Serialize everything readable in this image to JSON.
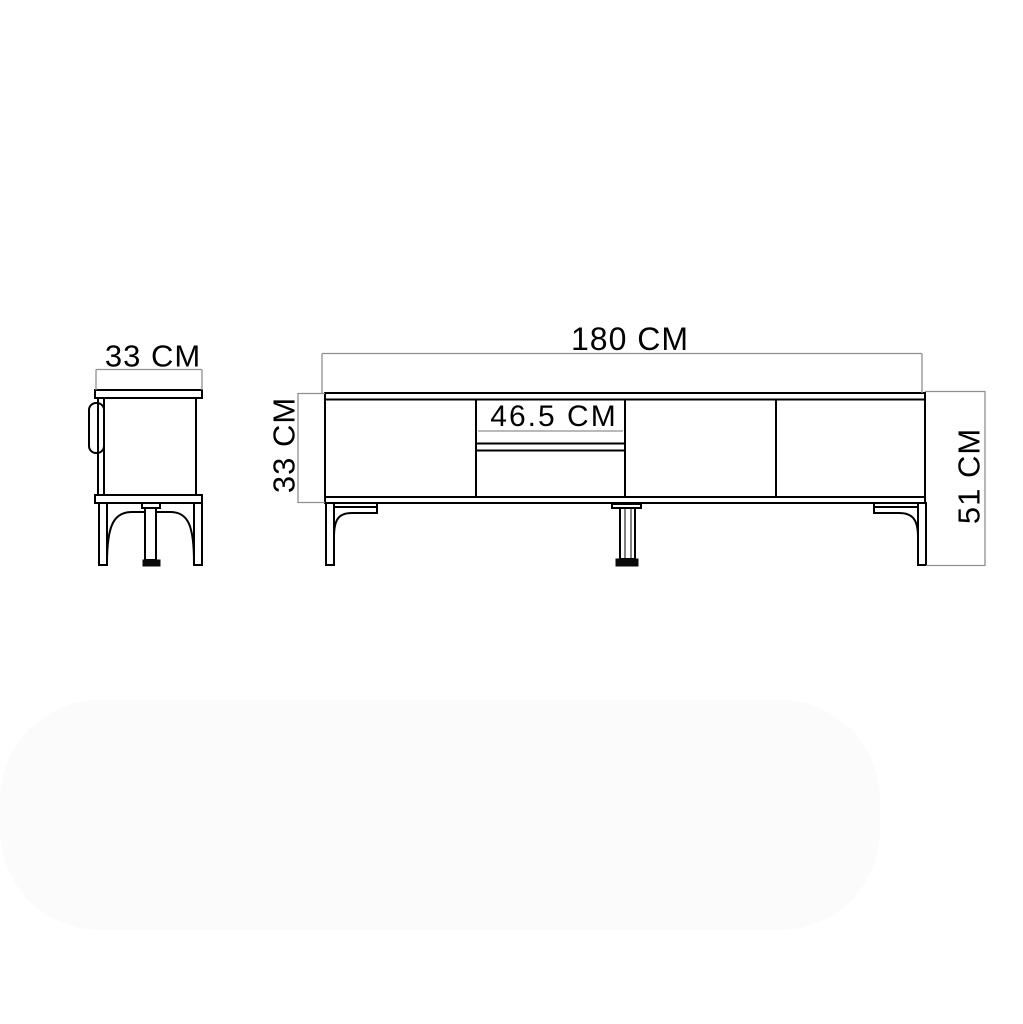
{
  "page": {
    "background_color": "#ffffff"
  },
  "drawing": {
    "type": "furniture-technical-drawing",
    "subject": "TV stand two-view dimension drawing",
    "line_color": "#000000",
    "dimension_line_color": "#8f8f8f",
    "text_color": "#000000",
    "side_view": {
      "width_label": "33 CM"
    },
    "front_view": {
      "width_label": "180 CM",
      "body_height_label": "33 CM",
      "middle_section_width_label": "46.5 CM",
      "total_height_label": "51 CM"
    }
  }
}
